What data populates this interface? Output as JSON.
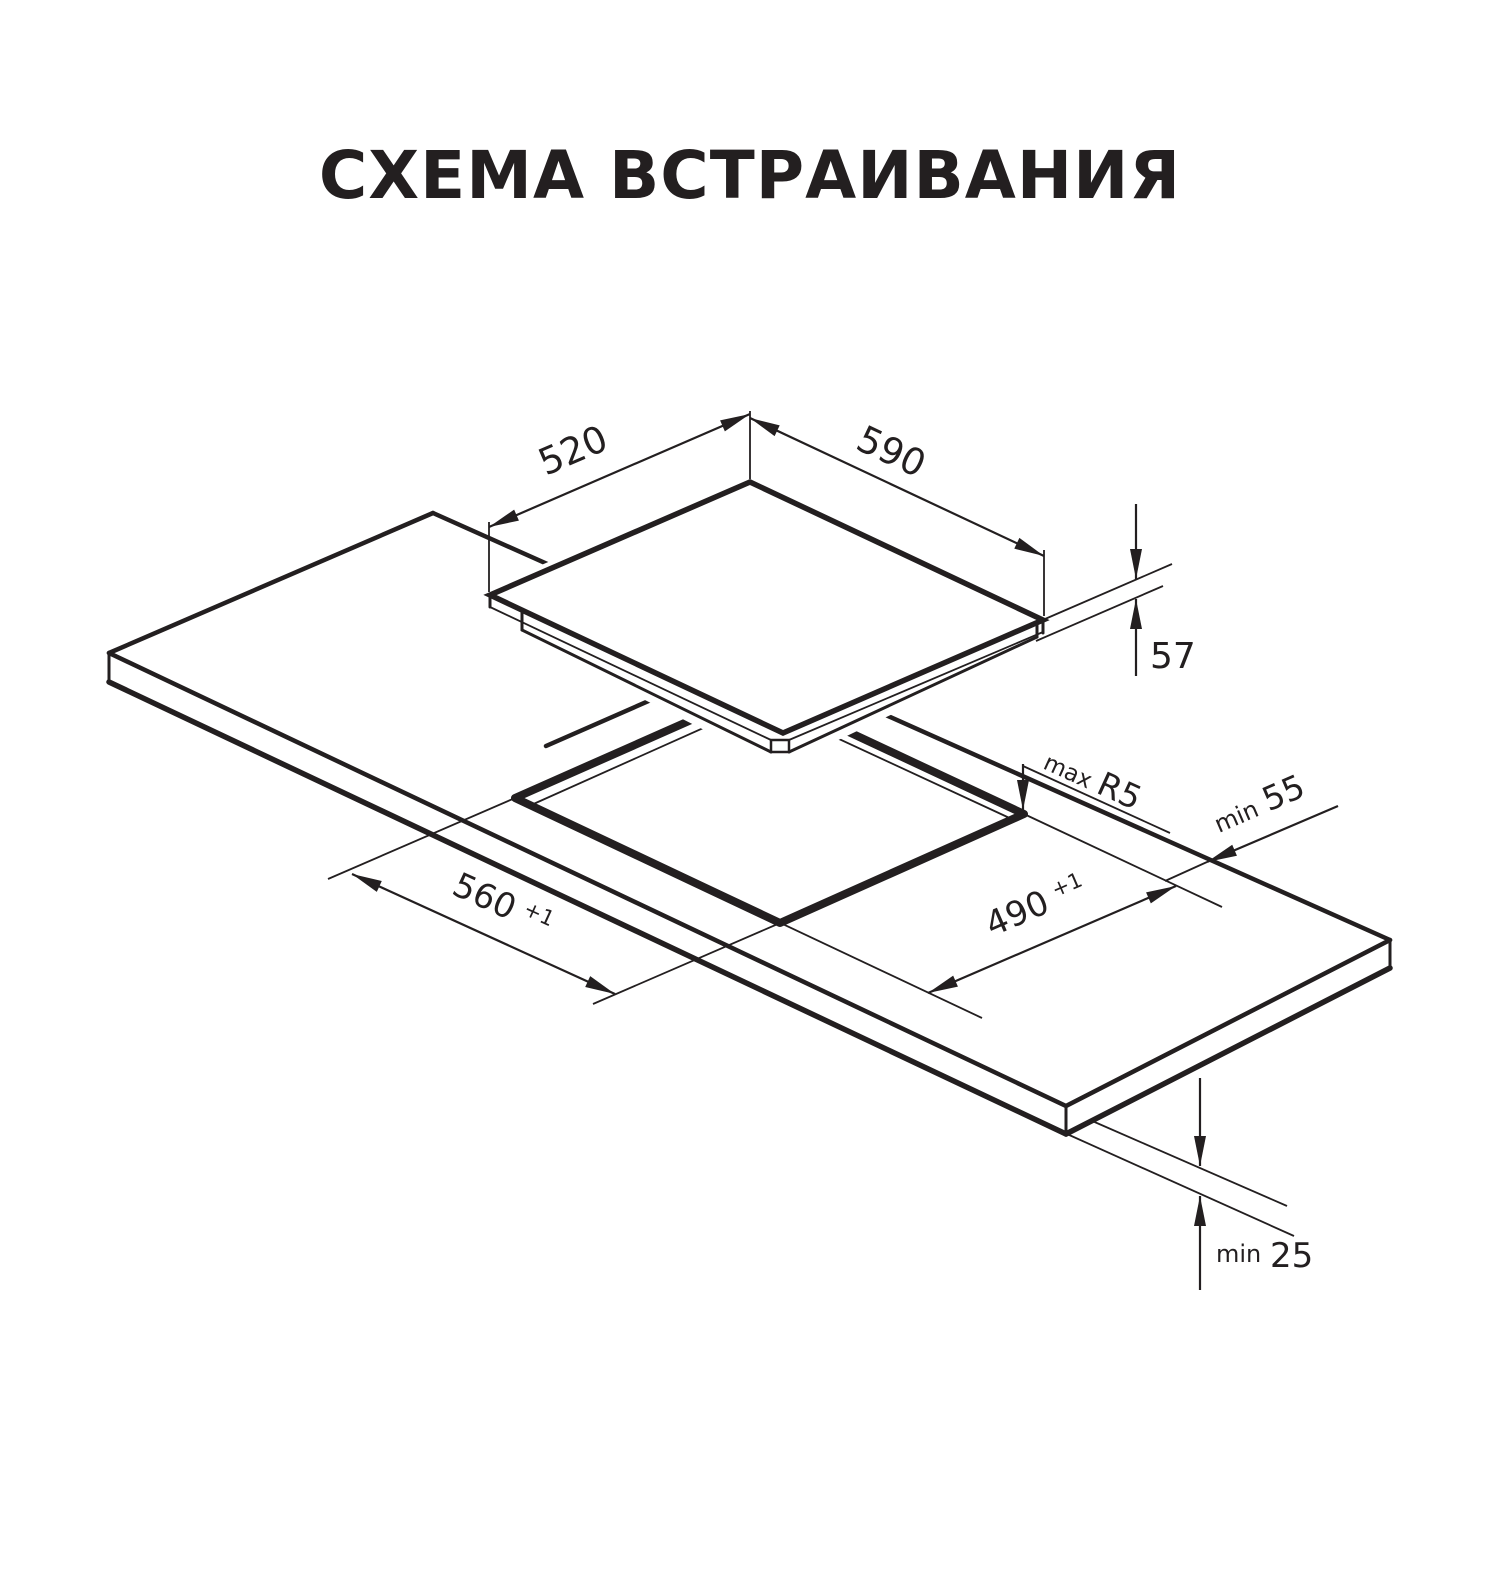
{
  "title": "СХЕМА ВСТРАИВАНИЯ",
  "colors": {
    "ink": "#231f20",
    "background": "#ffffff"
  },
  "diagram": {
    "dimensions": {
      "hob_depth": {
        "value": "520"
      },
      "hob_width": {
        "value": "590"
      },
      "hob_height": {
        "value": "57"
      },
      "corner_radius": {
        "prefix": "max",
        "value": "R5"
      },
      "rear_clearance": {
        "prefix": "min",
        "value": "55"
      },
      "cutout_width": {
        "value": "560",
        "tolerance": "+1"
      },
      "cutout_depth": {
        "value": "490",
        "tolerance": "+1"
      },
      "bottom_clearance": {
        "prefix": "min",
        "value": "25"
      }
    }
  }
}
